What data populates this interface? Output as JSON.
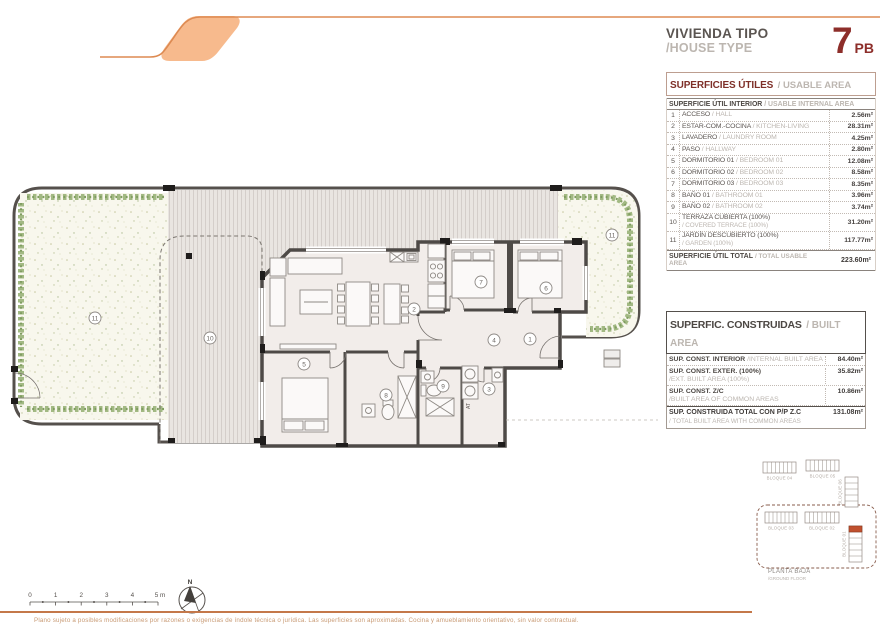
{
  "header": {
    "title_es": "VIVIENDA TIPO",
    "title_en": "/HOUSE TYPE",
    "unit_number": "7",
    "unit_floor": "PB"
  },
  "usable_table": {
    "title_es": "SUPERFICIES ÚTILES",
    "title_en": "/ USABLE AREA",
    "subtitle_es": "SUPERFICIE ÚTIL INTERIOR",
    "subtitle_en": "/ USABLE INTERNAL AREA",
    "rows": [
      {
        "num": "1",
        "name_es": "ACCESO",
        "name_en": "/ HALL",
        "value": "2.56m²",
        "two_line": false
      },
      {
        "num": "2",
        "name_es": "ESTAR-COM.-COCINA",
        "name_en": "/ KITCHEN-LIVING",
        "value": "28.31m²",
        "two_line": false
      },
      {
        "num": "3",
        "name_es": "LAVADERO",
        "name_en": "/ LAUNDRY ROOM",
        "value": "4.25m²",
        "two_line": false
      },
      {
        "num": "4",
        "name_es": "PASO",
        "name_en": "/ HALLWAY",
        "value": "2.80m²",
        "two_line": false
      },
      {
        "num": "5",
        "name_es": "DORMITORIO 01",
        "name_en": "/ BEDROOM 01",
        "value": "12.08m²",
        "two_line": false
      },
      {
        "num": "6",
        "name_es": "DORMITORIO 02",
        "name_en": "/ BEDROOM 02",
        "value": "8.58m²",
        "two_line": false
      },
      {
        "num": "7",
        "name_es": "DORMITORIO 03",
        "name_en": "/ BEDROOM 03",
        "value": "8.35m²",
        "two_line": false
      },
      {
        "num": "8",
        "name_es": "BAÑO 01",
        "name_en": "/ BATHROOM 01",
        "value": "3.96m²",
        "two_line": false
      },
      {
        "num": "9",
        "name_es": "BAÑO 02",
        "name_en": "/ BATHROOM 02",
        "value": "3.74m²",
        "two_line": false
      },
      {
        "num": "10",
        "name_es": "TERRAZA CUBIERTA (100%)",
        "name_en": "/ COVERED TERRACE (100%)",
        "value": "31.20m²",
        "two_line": true
      },
      {
        "num": "11",
        "name_es": "JARDÍN DESCUBIERTO (100%)",
        "name_en": "/ GARDEN (100%)",
        "value": "117.77m²",
        "two_line": true
      }
    ],
    "total_label_es": "SUPERFICIE ÚTIL TOTAL",
    "total_label_en": "/ TOTAL USABLE AREA",
    "total_value": "223.60m²"
  },
  "built_table": {
    "title_es": "SUPERFIC. CONSTRUIDAS",
    "title_en": "/ BUILT AREA",
    "rows": [
      {
        "name_es": "SUP. CONST. INTERIOR",
        "name_en": "/INTERNAL BUILT AREA",
        "value": "84.40m²",
        "two_line": false
      },
      {
        "name_es": "SUP. CONST. EXTER. (100%)",
        "name_en": "/EXT. BUILT AREA (100%)",
        "value": "35.82m²",
        "two_line": true
      },
      {
        "name_es": "SUP. CONST. Z/C",
        "name_en": "/BUILT AREA OF COMMON AREAS",
        "value": "10.86m²",
        "two_line": true
      }
    ],
    "total_label_es": "SUP. CONSTRUIDA TOTAL CON P/P Z.C",
    "total_label_en": "/ TOTAL BUILT AREA WITH COMMON AREAS",
    "total_value": "131.08m²"
  },
  "floor_plan": {
    "laundry_tag": "AT",
    "north_label": "N",
    "room_labels": [
      {
        "n": "11",
        "x": 95,
        "y": 318
      },
      {
        "n": "10",
        "x": 210,
        "y": 338
      },
      {
        "n": "2",
        "x": 414,
        "y": 309
      },
      {
        "n": "5",
        "x": 304,
        "y": 364
      },
      {
        "n": "7",
        "x": 481,
        "y": 282
      },
      {
        "n": "6",
        "x": 546,
        "y": 288
      },
      {
        "n": "4",
        "x": 494,
        "y": 340
      },
      {
        "n": "1",
        "x": 530,
        "y": 339
      },
      {
        "n": "8",
        "x": 386,
        "y": 395
      },
      {
        "n": "9",
        "x": 443,
        "y": 386
      },
      {
        "n": "3",
        "x": 489,
        "y": 389
      },
      {
        "n": "11",
        "x": 612,
        "y": 235
      }
    ]
  },
  "key_plan": {
    "caption_es": "PLANTA BAJA",
    "caption_en": "/GROUND FLOOR",
    "blocks": [
      {
        "label": "BLOQUE 04",
        "x": 763,
        "y": 462,
        "w": 33,
        "h": 11,
        "cells": 8,
        "dir": "h"
      },
      {
        "label": "BLOQUE 05",
        "x": 806,
        "y": 460,
        "w": 33,
        "h": 11,
        "cells": 8,
        "dir": "h"
      },
      {
        "label": "BLOQUE 06",
        "x": 845,
        "y": 477,
        "w": 13,
        "h": 30,
        "cells": 5,
        "dir": "v"
      },
      {
        "label": "BLOQUE 03",
        "x": 765,
        "y": 512,
        "w": 32,
        "h": 11,
        "cells": 8,
        "dir": "h"
      },
      {
        "label": "BLOQUE 02",
        "x": 805,
        "y": 512,
        "w": 34,
        "h": 11,
        "cells": 8,
        "dir": "h"
      },
      {
        "label": "BLOQUE 01",
        "x": 849,
        "y": 526,
        "w": 13,
        "h": 36,
        "cells": 6,
        "dir": "v",
        "highlight_cell": 0
      }
    ]
  },
  "scale_bar": {
    "labels": [
      "0",
      "1",
      "2",
      "3",
      "4",
      "5 m"
    ]
  },
  "disclaimer": "Plano sujeto a posibles modificaciones por razones o exigencias de índole técnica o jurídica. Las superficies son aproximadas. Cocina y amueblamiento orientativo, sin valor contractual.",
  "colors": {
    "accent_red": "#8d2e2a",
    "logo_stroke": "#dd8a52",
    "logo_fill": "#f7ba8d",
    "divider": "#c4784a",
    "disclaimer_text": "#c89a74",
    "block_highlight": "#c0502e",
    "hedge_green": "#9db47c",
    "wall": "#4e4a47"
  }
}
